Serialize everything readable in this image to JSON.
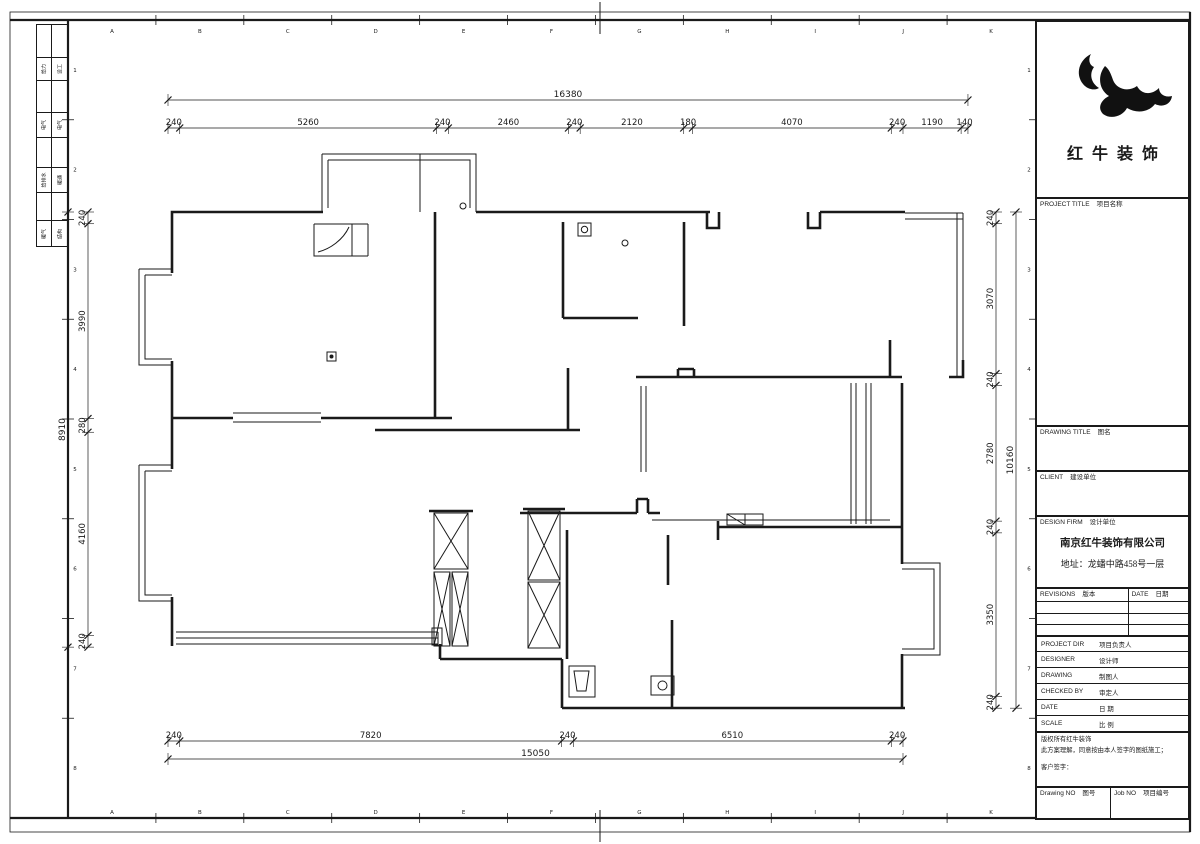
{
  "brand": {
    "name": "红牛装饰"
  },
  "frame": {
    "letters": [
      "A",
      "B",
      "C",
      "D",
      "E",
      "F",
      "G",
      "H",
      "I",
      "J",
      "K"
    ],
    "numbers": [
      "1",
      "2",
      "3",
      "4",
      "5",
      "6",
      "7",
      "8"
    ]
  },
  "signoff": {
    "rows": [
      [
        "给力",
        "设工"
      ],
      [
        "电气",
        "电气"
      ],
      [
        "给排水",
        "暖通"
      ],
      [
        "暖气",
        "结构"
      ]
    ]
  },
  "titleblock": {
    "project_title": {
      "en": "PROJECT TITLE",
      "cn": "项目名称"
    },
    "drawing_title": {
      "en": "DRAWING TITLE",
      "cn": "图名"
    },
    "client": {
      "en": "CLIENT",
      "cn": "建设单位"
    },
    "design_firm": {
      "en": "DESIGN FIRM",
      "cn": "设计单位"
    },
    "company": "南京红牛装饰有限公司",
    "address": "地址：龙蟠中路458号一层",
    "revisions": {
      "en": "REVISIONS",
      "cn": "版本"
    },
    "rev_date": {
      "en": "DATE",
      "cn": "日期"
    },
    "rows": [
      {
        "en": "PROJECT DIR",
        "cn": "项目负责人"
      },
      {
        "en": "DESIGNER",
        "cn": "设计师"
      },
      {
        "en": "DRAWING",
        "cn": "制图人"
      },
      {
        "en": "CHECKED BY",
        "cn": "审定人"
      },
      {
        "en": "DATE",
        "cn": "日  期"
      },
      {
        "en": "SCALE",
        "cn": "比  例"
      }
    ],
    "copyright_line1": "版权所有红牛装饰",
    "copyright_line2": "此方案理解，同意按由本人签字的图纸施工；",
    "customer_sign": "客户签字：",
    "drawing_no": {
      "en": "Drawing NO",
      "cn": "图号"
    },
    "job_no": {
      "en": "Job NO",
      "cn": "项目编号"
    }
  },
  "dimensions": {
    "top": {
      "total": 16380,
      "segments": [
        240,
        5260,
        240,
        2460,
        240,
        2120,
        180,
        4070,
        240,
        1190,
        140
      ]
    },
    "bottom": {
      "total": 15050,
      "segments": [
        240,
        7820,
        240,
        6510,
        240
      ]
    },
    "left": {
      "total": 8910,
      "segments": [
        240,
        3990,
        280,
        4160,
        240
      ]
    },
    "right": {
      "total": 10160,
      "segments": [
        240,
        3070,
        240,
        2780,
        240,
        3350,
        240
      ]
    }
  },
  "colors": {
    "line": "#1a1a1a",
    "paper": "#ffffff"
  }
}
